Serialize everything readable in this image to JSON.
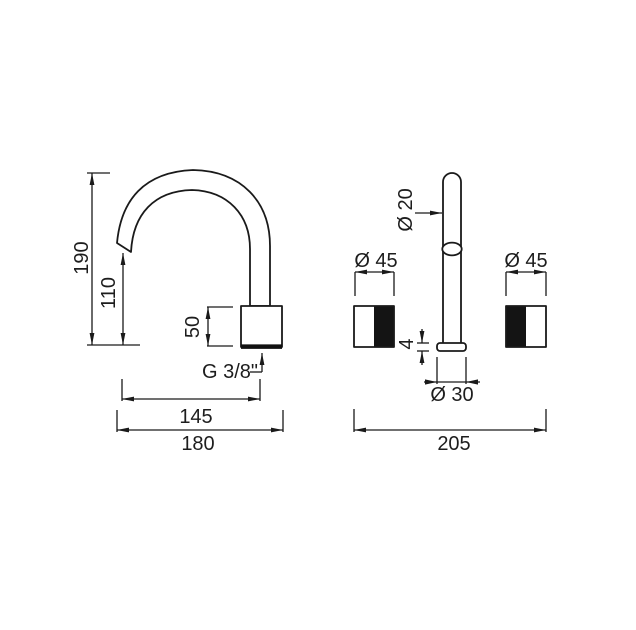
{
  "page": {
    "background": "#ffffff"
  },
  "drawing": {
    "type": "technical-dimension-drawing",
    "subject": "two-hole basin mixer with gooseneck spout and two handles",
    "colors": {
      "line": "#1a1a1a",
      "text": "#1d1d1d",
      "fill_black": "#141414",
      "background": "#ffffff"
    },
    "views": {
      "side_view": {
        "name": "spout side view",
        "labels": {
          "height_total": "190",
          "spout_height": "110",
          "body_height": "50",
          "thread": "G 3/8\"",
          "spout_reach": "145",
          "depth_total": "180"
        }
      },
      "front_view": {
        "name": "front view with handles",
        "labels": {
          "spout_diameter": "Ø 20",
          "handle_diameter_left": "Ø 45",
          "handle_diameter_right": "Ø 45",
          "flange_height": "4",
          "flange_diameter": "Ø 30",
          "width_total": "205"
        }
      }
    }
  }
}
